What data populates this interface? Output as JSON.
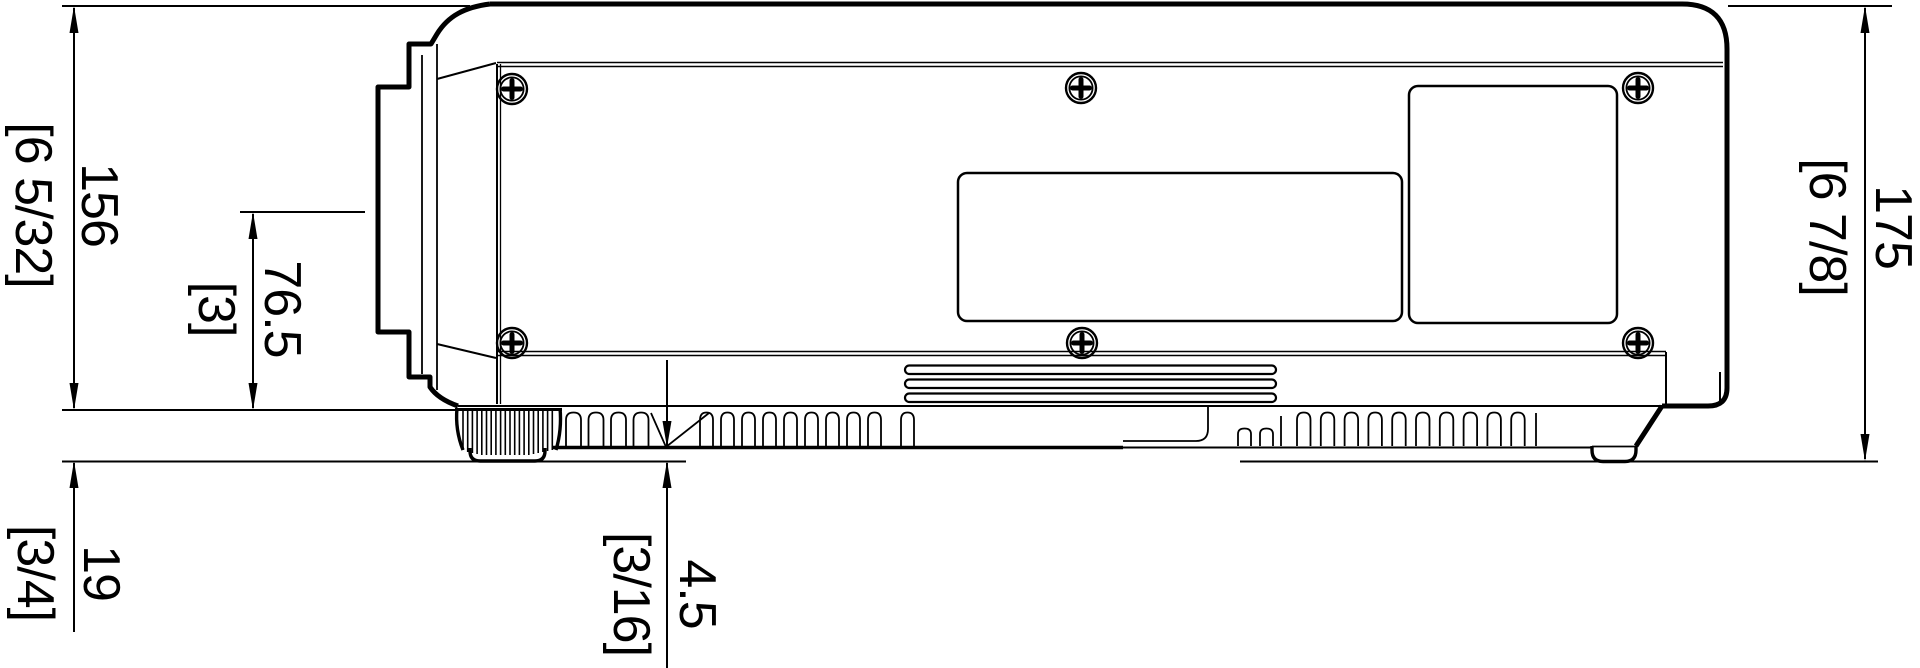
{
  "page": {
    "background_color": "#ffffff",
    "line_color": "#000000"
  },
  "drawing": {
    "type": "technical-dimension-drawing",
    "subject": "projector-side-view",
    "units": "millimetres with [inches] in brackets",
    "dimensions": [
      {
        "id": "body-height",
        "mm": "156",
        "inches": "[6 5/32]"
      },
      {
        "id": "lens-center-height",
        "mm": "76.5",
        "inches": "[3]"
      },
      {
        "id": "total-height",
        "mm": "175",
        "inches": "[6 7/8]"
      },
      {
        "id": "foot-height",
        "mm": "19",
        "inches": "[3/4]"
      },
      {
        "id": "bottom-clearance",
        "mm": "4.5",
        "inches": "[3/16]"
      }
    ]
  }
}
